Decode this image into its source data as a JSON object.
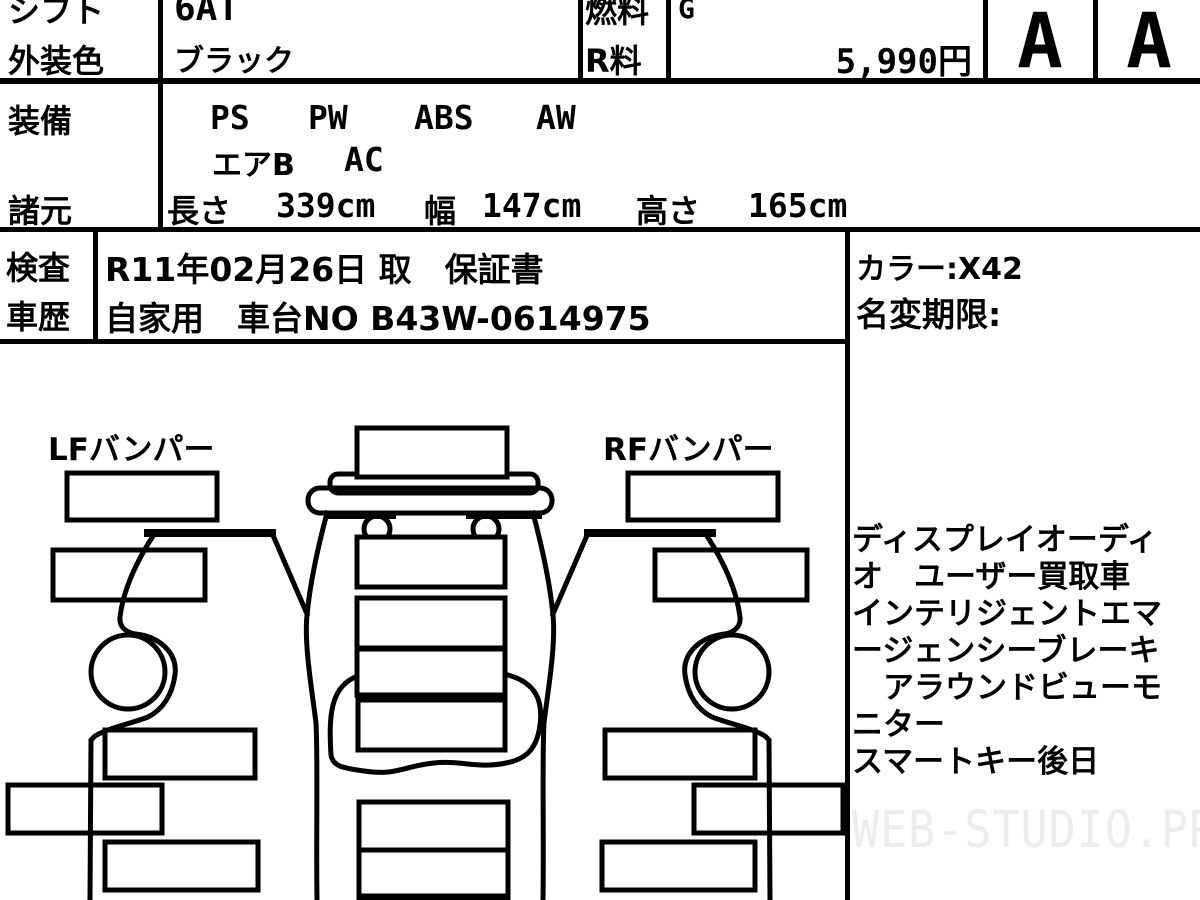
{
  "header": {
    "shift": {
      "label": "シフト",
      "value": "6AT"
    },
    "exterior_color": {
      "label": "外装色",
      "value": "ブラック"
    },
    "fuel": {
      "label": "燃料",
      "value": "G"
    },
    "recycle_fee": {
      "label": "R料",
      "value": "5,990円"
    },
    "grades": [
      "A",
      "A"
    ]
  },
  "equipment": {
    "label": "装備",
    "row1": [
      "PS",
      "PW",
      "ABS",
      "AW"
    ],
    "row2": [
      "エアB",
      "AC"
    ]
  },
  "specs": {
    "label": "諸元",
    "length_label": "長さ",
    "length_value": "339cm",
    "width_label": "幅",
    "width_value": "147cm",
    "height_label": "高さ",
    "height_value": "165cm"
  },
  "inspection": {
    "label": "検査",
    "value": "R11年02月26日 取　保証書"
  },
  "history": {
    "label": "車歴",
    "value": "自家用　車台NO B43W-0614975"
  },
  "side_info": {
    "color_code": "カラー:X42",
    "name_change": "名変期限:"
  },
  "diagram": {
    "lf_label": "LFバンパー",
    "rf_label": "RFバンパー"
  },
  "notes": {
    "lines": [
      "ディスプレイオーディ",
      "オ　ユーザー買取車",
      "インテリジェントエマ",
      "ージェンシーブレーキ",
      "　アラウンドビューモ",
      "ニター",
      "スマートキー後日"
    ]
  },
  "watermark": "WEB-STUDIO.PRO"
}
